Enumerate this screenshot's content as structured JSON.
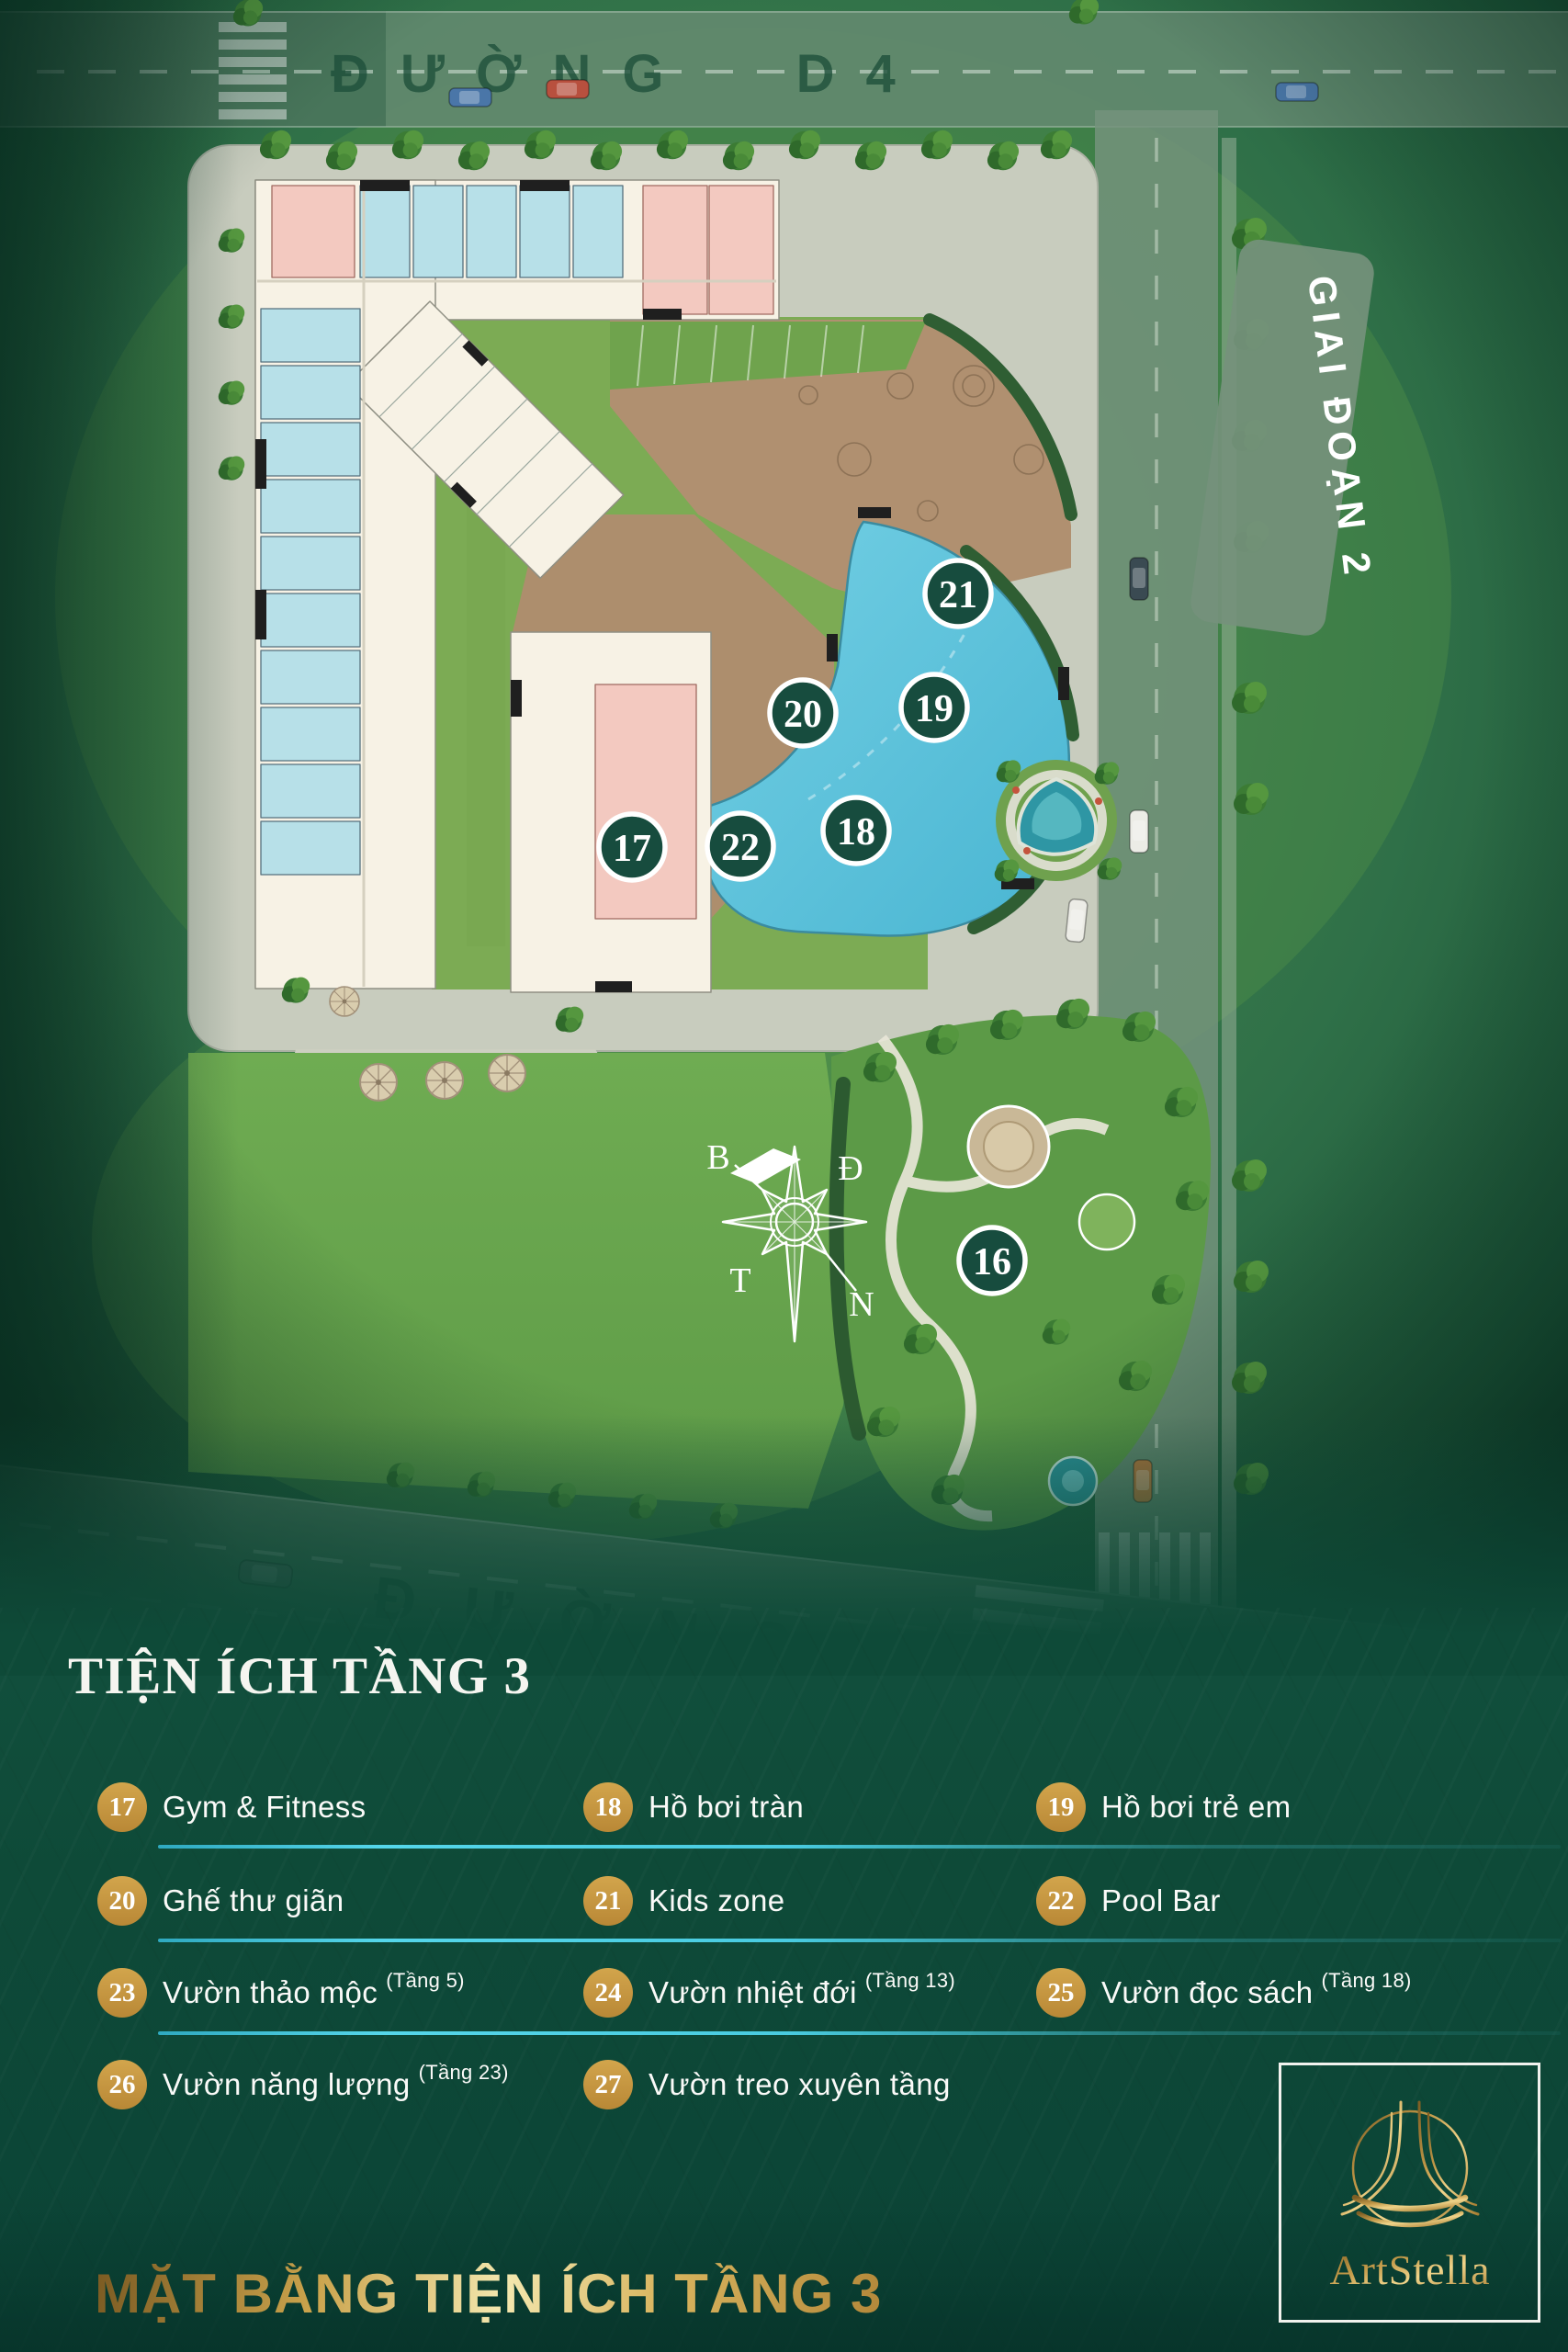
{
  "map": {
    "top_road_label": "ĐƯỜNG D4",
    "bottom_road_label": "ĐƯỜNG",
    "phase_banner": "GIAI ĐOẠN 2",
    "compass": {
      "north_label": "B",
      "east_label": "Đ",
      "west_label": "T",
      "south_label": "N"
    },
    "markers": [
      {
        "number": "16"
      },
      {
        "number": "17"
      },
      {
        "number": "18"
      },
      {
        "number": "19"
      },
      {
        "number": "20"
      },
      {
        "number": "21"
      },
      {
        "number": "22"
      }
    ]
  },
  "legend": {
    "title": "TIỆN ÍCH TẦNG 3",
    "items": [
      {
        "num": "17",
        "label": "Gym & Fitness",
        "floor_note": ""
      },
      {
        "num": "18",
        "label": "Hồ bơi tràn",
        "floor_note": ""
      },
      {
        "num": "19",
        "label": "Hồ bơi trẻ em",
        "floor_note": ""
      },
      {
        "num": "20",
        "label": "Ghế thư giãn",
        "floor_note": ""
      },
      {
        "num": "21",
        "label": "Kids zone",
        "floor_note": ""
      },
      {
        "num": "22",
        "label": "Pool Bar",
        "floor_note": ""
      },
      {
        "num": "23",
        "label": "Vườn thảo mộc",
        "floor_note": "(Tầng 5)"
      },
      {
        "num": "24",
        "label": "Vườn nhiệt đới",
        "floor_note": "(Tầng 13)"
      },
      {
        "num": "25",
        "label": "Vườn đọc sách",
        "floor_note": "(Tầng 18)"
      },
      {
        "num": "26",
        "label": "Vườn năng lượng",
        "floor_note": "(Tầng 23)"
      },
      {
        "num": "27",
        "label": "Vườn treo xuyên tầng",
        "floor_note": ""
      }
    ]
  },
  "footer": {
    "title": "MẶT BẰNG TIỆN ÍCH TẦNG 3"
  },
  "brand": {
    "name": "ArtStella"
  },
  "colors": {
    "marker_circle": "#174c3e",
    "legend_badge_gold": "#c8983f",
    "separator_cyan": "#4fc9de",
    "footer_gold": "#d8b45e",
    "page_green": "#0e4a38",
    "pool_blue": "#5fc5dd",
    "deck_brown": "#ad8e6d"
  }
}
